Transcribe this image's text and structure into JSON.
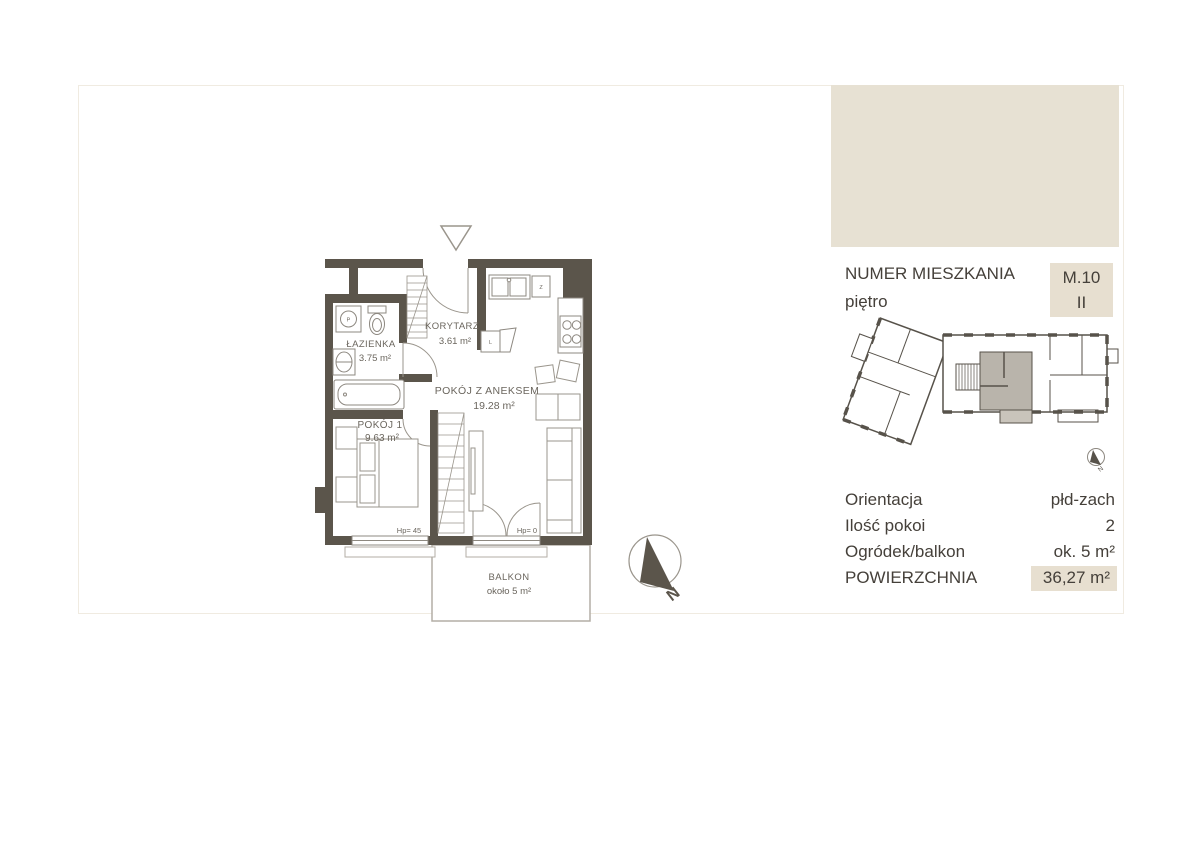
{
  "panel": {
    "apartment_number_label": "NUMER MIESZKANIA",
    "apartment_number_value": "M.10",
    "floor_label": "piętro",
    "floor_value": "II",
    "rows": [
      {
        "label": "Orientacja",
        "value": "płd-zach"
      },
      {
        "label": "Ilość pokoi",
        "value": "2"
      },
      {
        "label": "Ogródek/balkon",
        "value": "ok. 5 m²"
      },
      {
        "label": "POWIERZCHNIA",
        "value": "36,27 m²"
      }
    ]
  },
  "floorplan": {
    "rooms": {
      "bathroom": {
        "name": "ŁAZIENKA",
        "area": "3.75 m²"
      },
      "corridor": {
        "name": "KORYTARZ",
        "area": "3.61 m²"
      },
      "living": {
        "name": "POKÓJ Z ANEKSEM",
        "area": "19.28 m²"
      },
      "bedroom": {
        "name": "POKÓJ 1",
        "area": "9.63 m²"
      },
      "balcony": {
        "name": "BALKON",
        "area": "około 5 m²"
      }
    },
    "window_labels": {
      "bedroom": "Hp= 45",
      "balcony": "Hp= 0"
    },
    "fixtures": {
      "washer": "P",
      "dishwasher": "Z",
      "fridge": "L"
    },
    "compass_label": "N",
    "mini_compass_label": "N"
  },
  "colors": {
    "wall": "#5b554b",
    "line": "#8d8880",
    "light_line": "#b3aea5",
    "room_label": "#6b665e",
    "panel_text": "#45403a",
    "beige": "#e7e1d3",
    "beige_box": "#e7dfd0",
    "unit_highlight": "#b9b4ab",
    "unit_balcony": "#c9c4bb"
  }
}
